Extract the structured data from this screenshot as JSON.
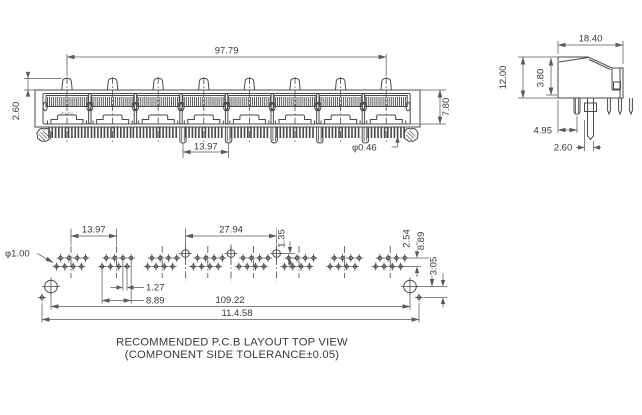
{
  "drawing": {
    "colors": {
      "line": "#4a4a4a",
      "dimension": "#5a5a5a",
      "text": "#3a3a3a",
      "background": "#ffffff"
    },
    "front_view": {
      "port_count": 8,
      "port_marking": "CLCI",
      "dim_port_span": "97.79",
      "dim_latch_height": "2.60",
      "dim_opening_height": "7.80",
      "dim_peg_pitch": "13.97",
      "dim_pin_diameter": "φ0.46"
    },
    "side_view": {
      "dim_depth": "18.40",
      "dim_height": "12.00",
      "dim_contact_height": "3.80",
      "dim_peg_offset": "4.95",
      "dim_tab_offset": "2.60"
    },
    "pcb_layout": {
      "pads_per_group": 8,
      "dim_group_pitch": "13.97",
      "dim_center_pad_span": "27.94",
      "dim_row_offset": "1.35",
      "dim_hole_diameter": "φ1.00",
      "dim_pad_pitch": "1.27",
      "dim_group_span": "8.89",
      "dim_row_spacing": "2.54",
      "dim_hole_to_row": "8.89",
      "dim_hole_to_pad": "3.05",
      "dim_mount_hole_span": "109.22",
      "dim_overall_span": "11.4.58",
      "caption_line1": "RECOMMENDED P.C.B LAYOUT TOP VIEW",
      "caption_line2": "(COMPONENT SIDE TOLERANCE±0.05)"
    }
  }
}
